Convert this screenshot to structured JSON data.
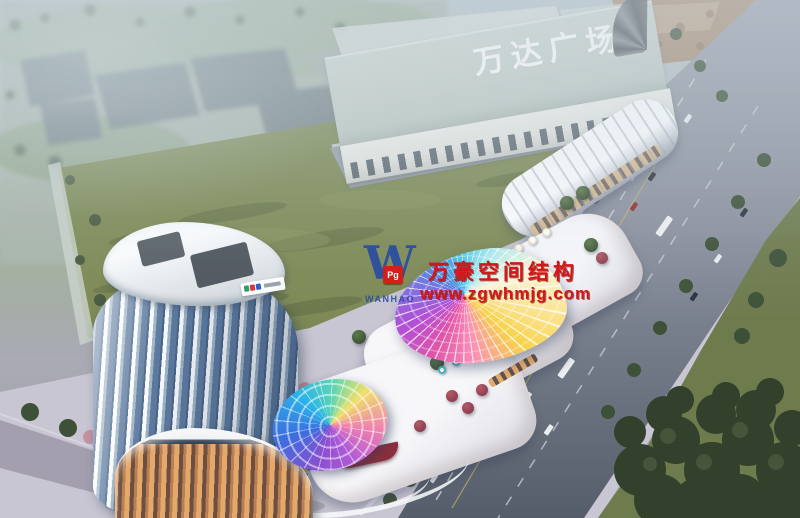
{
  "signs": {
    "mall_rooftop_sign": "万达广场"
  },
  "watermark": {
    "logo_letter": "W",
    "logo_seal": "Pg",
    "logo_word": "WANHAO",
    "company_name": "万豪空间结构",
    "website": "www.zgwhmjg.com",
    "text_color": "#d61616",
    "logo_color": "#2a4da3"
  },
  "palette": {
    "haze_sky": "#b9c6cc",
    "field_green": "#7d8a55",
    "tree_green": "#3c5138",
    "road_gray": "#8a909d",
    "plaza_gray": "#c9c6d3",
    "tower_glass_blue": "#5d7a9e",
    "warm_retail_glow": "#e0a868",
    "watermark_red": "#d61616",
    "canopy_rainbow": [
      "#f7d24a",
      "#fa8fb8",
      "#e254a8",
      "#b14fd6",
      "#7e6de0",
      "#3e8de0",
      "#49c8e8"
    ]
  }
}
